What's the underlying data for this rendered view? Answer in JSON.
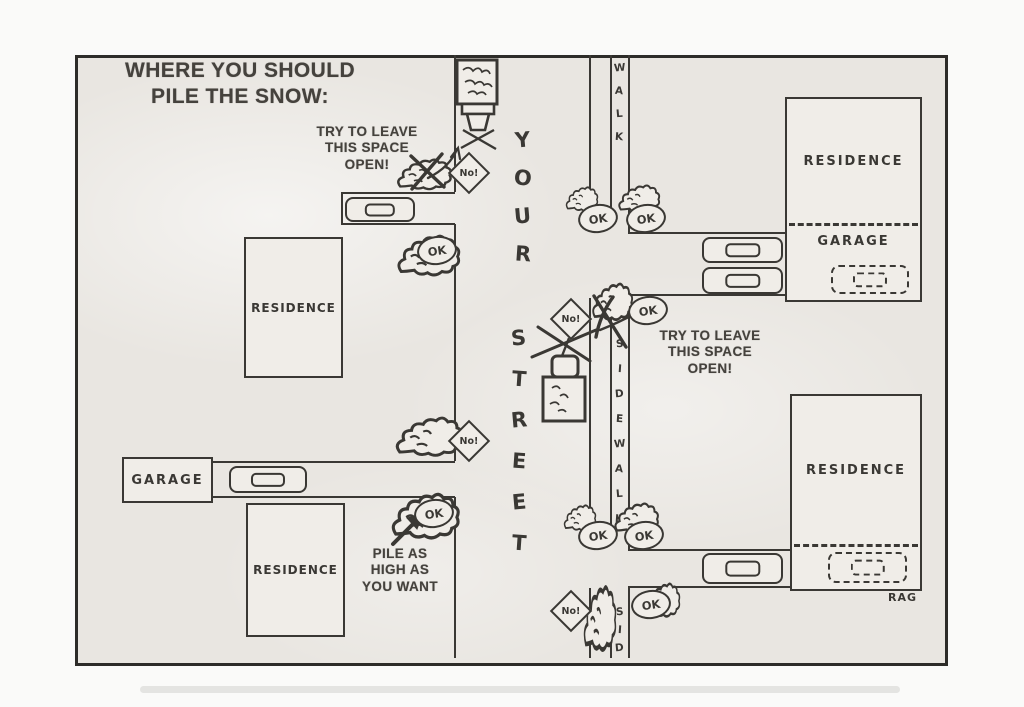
{
  "title": {
    "line1": "WHERE YOU SHOULD",
    "line2": "PILE THE SNOW:"
  },
  "notes": {
    "leave_open_top": {
      "l1": "TRY TO LEAVE",
      "l2": "THIS SPACE",
      "l3": "OPEN!"
    },
    "leave_open_right": {
      "l1": "TRY TO LEAVE",
      "l2": "THIS SPACE",
      "l3": "OPEN!"
    },
    "pile_high": {
      "l1": "PILE AS",
      "l2": "HIGH AS",
      "l3": "YOU WANT"
    }
  },
  "street": {
    "word1": "YOUR",
    "word2": "STREET"
  },
  "sidewalks": {
    "top": "WALK",
    "middle": "SIDEWALK",
    "bottom": "SID"
  },
  "labels": {
    "residence": "RESIDENCE",
    "garage": "GARAGE"
  },
  "signs": {
    "ok": "OK",
    "no": "No!"
  },
  "signature": "RAG",
  "colors": {
    "ink": "#3a3834",
    "paper": "#e9e6e1",
    "print_text": "#45423d"
  }
}
